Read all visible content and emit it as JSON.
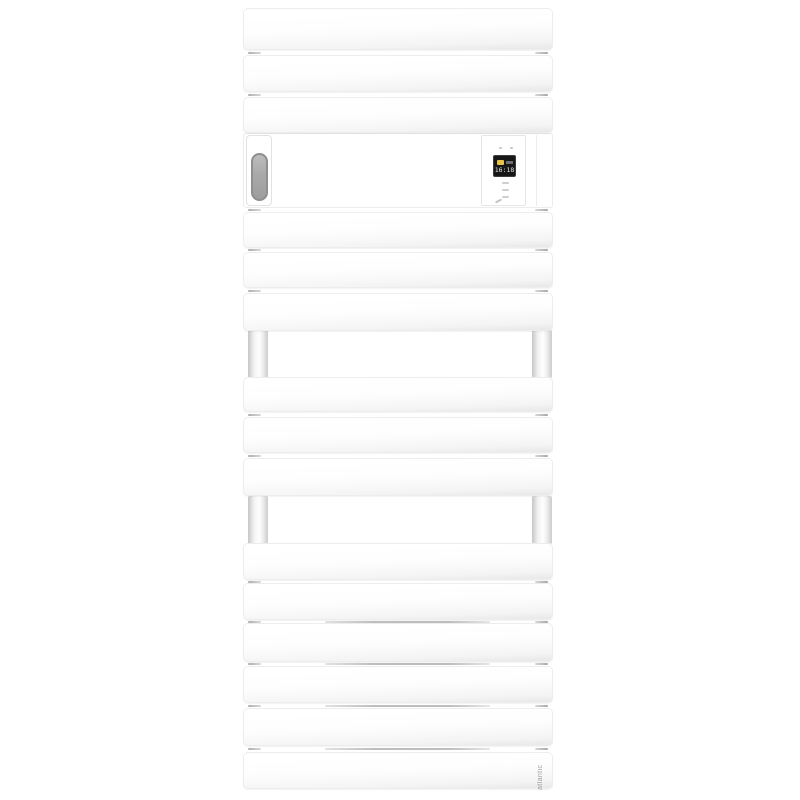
{
  "product": {
    "type_label": "electric towel radiator",
    "brand_label": "atlantic",
    "colors": {
      "body": "#ffffff",
      "capsule_grey": "#a5a5a5",
      "display_background": "#171717",
      "display_accent_yellow": "#e6c34c",
      "shadow_grey": "#bdbdbd"
    }
  },
  "control_panel": {
    "display_text": "16:18",
    "display_icon": "comfort-mode-icon",
    "indicator_dots": 2,
    "touch_button_marks": 3
  }
}
